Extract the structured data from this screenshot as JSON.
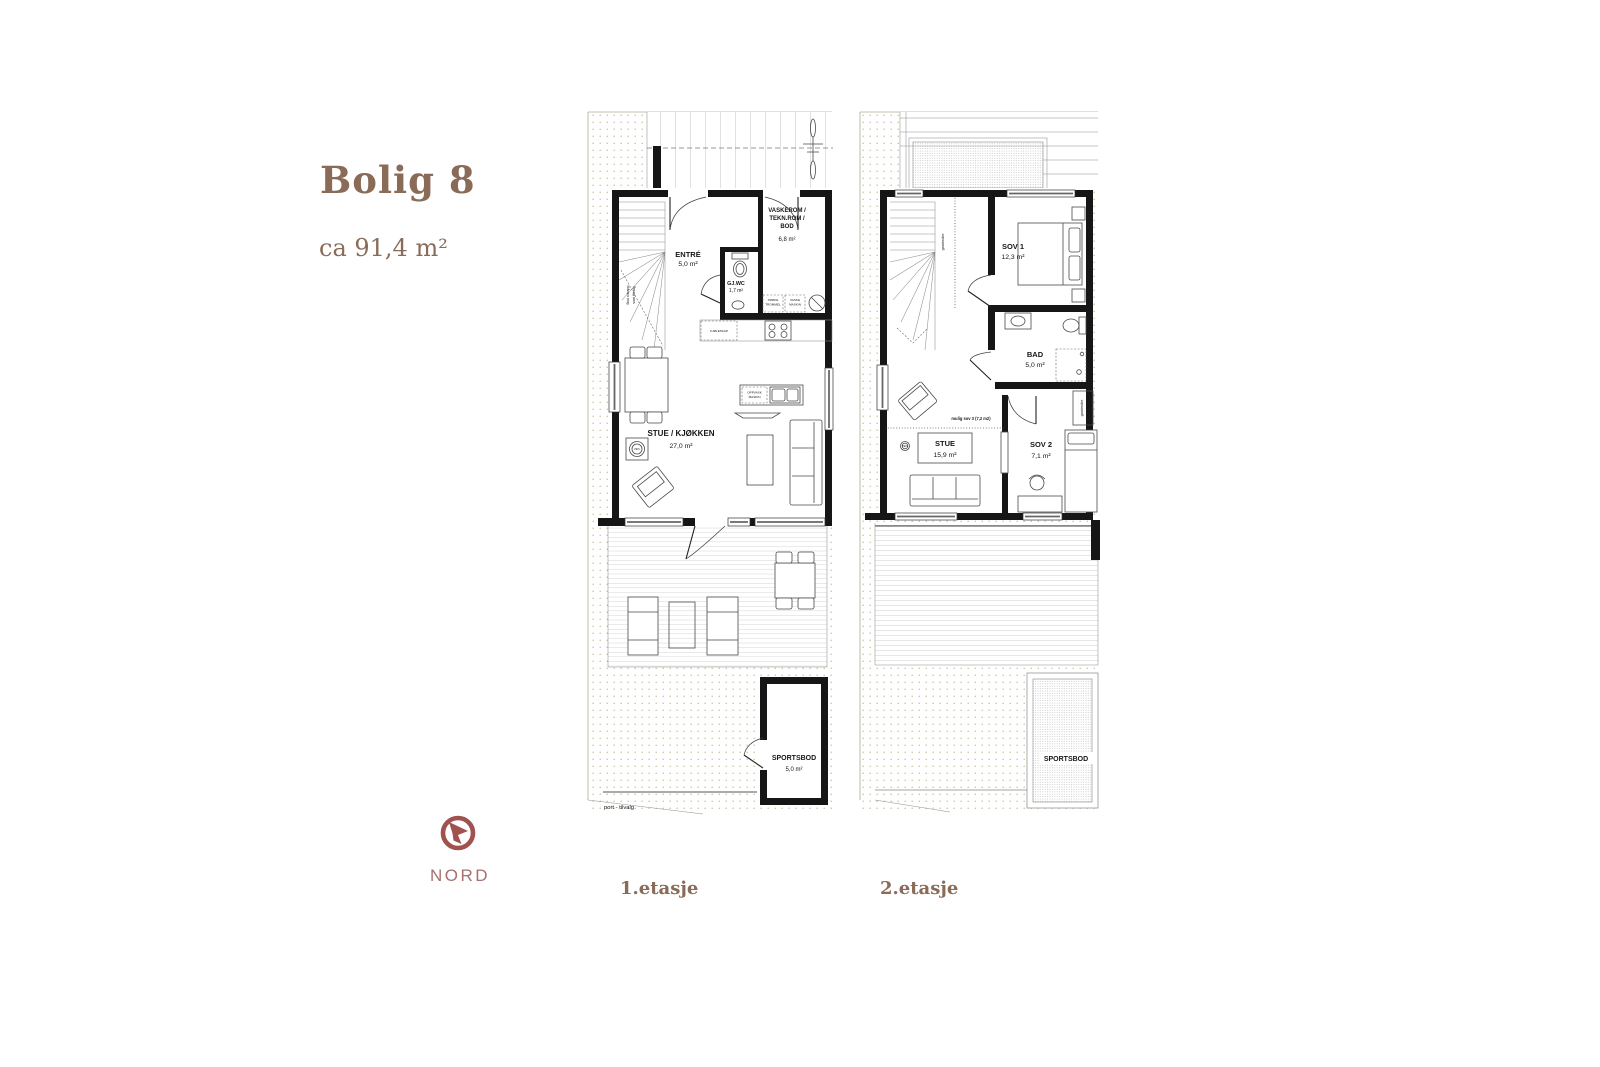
{
  "header": {
    "title": "Bolig 8",
    "area": "ca 91,4 m²"
  },
  "compass": {
    "label": "NORD"
  },
  "colors": {
    "accent_brown": "#8a6b57",
    "compass_red": "#a0524f",
    "wall_black": "#161616",
    "ground_dot_beige": "#cbbf9e"
  },
  "floor1": {
    "caption": "1.etasje",
    "rooms": {
      "entre": {
        "name": "ENTRÉ",
        "area": "5,0 m²"
      },
      "wc": {
        "name": "GJ.WC",
        "area": "1,7 m²"
      },
      "vaskerom": {
        "line1": "VASKEROM /",
        "line2": "TEKN.ROM /",
        "line3": "BOD",
        "area": "6,8 m²"
      },
      "stue": {
        "name": "STUE / KJØKKEN",
        "area": "27,0 m²"
      },
      "sportsbod": {
        "name": "SPORTSBOD",
        "area": "5,0 m²"
      }
    },
    "annotations": {
      "fridge": "KJØLESKAP",
      "dishwasher1": "OPPVASK",
      "dishwasher2": "MASKIN",
      "dryer1": "TØRKE",
      "dryer2": "TROMMEL",
      "washer1": "VASKE",
      "washer2": "MASKIN",
      "fireplace": "PEIS",
      "bod1": "Bod u/trapp",
      "bod2": "som tilvalg",
      "gate": "port - tilvalg"
    }
  },
  "floor2": {
    "caption": "2.etasje",
    "rooms": {
      "sov1": {
        "name": "SOV 1",
        "area": "12,3 m²"
      },
      "bad": {
        "name": "BAD",
        "area": "5,0 m²"
      },
      "stue": {
        "name": "STUE",
        "area": "15,9 m²"
      },
      "sov2": {
        "name": "SOV 2",
        "area": "7,1 m²"
      },
      "sportsbod": {
        "name": "SPORTSBOD"
      }
    },
    "annotations": {
      "wardrobe1": "garderobe",
      "wardrobe2": "garderobe",
      "possible_room": "mulig sov 3 (7,2 m2)",
      "fireplace": "PEIS"
    }
  }
}
